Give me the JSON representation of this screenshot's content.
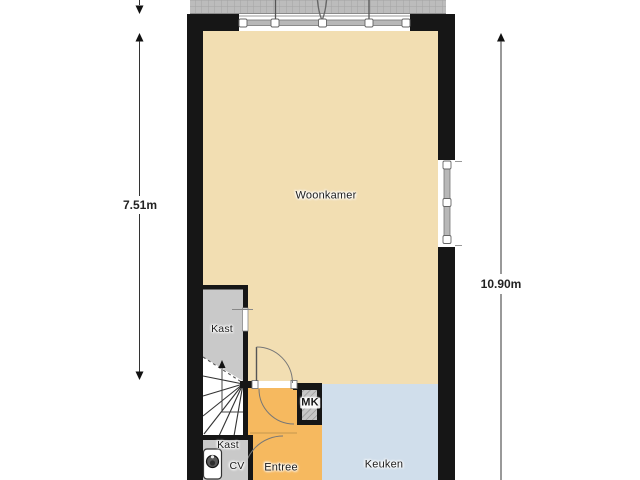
{
  "floorplan": {
    "type": "floor-plan",
    "rooms": [
      {
        "id": "woonkamer",
        "label": "Woonkamer",
        "color": "#f2deb2"
      },
      {
        "id": "keuken",
        "label": "Keuken",
        "color": "#d0deeb"
      },
      {
        "id": "entree",
        "label": "Entree",
        "color": "#f6b95f"
      },
      {
        "id": "kast-woonkamer",
        "label": "Kast",
        "color": "#c9c9c9"
      },
      {
        "id": "kast-hal",
        "label": "Kast",
        "color": "#c9c9c9"
      },
      {
        "id": "mk",
        "label": "MK",
        "color": "#c6c6c6"
      },
      {
        "id": "cv",
        "label": "CV",
        "color": "#c9c9c9"
      }
    ],
    "dimensions": [
      {
        "side": "left",
        "label": "7.51m"
      },
      {
        "side": "right",
        "label": "10.90m"
      }
    ],
    "icons": [
      {
        "name": "cv-boiler-icon"
      }
    ],
    "colors": {
      "wall": "#161616",
      "woonkamer": "#f2deb2",
      "keuken": "#d0deeb",
      "entree": "#f6b95f",
      "closet_gray": "#c9c9c9",
      "terrace_gray": "#bcbcbc",
      "dimension_line": "#333333",
      "door_arc": "#777777",
      "background": "#ffffff"
    }
  }
}
